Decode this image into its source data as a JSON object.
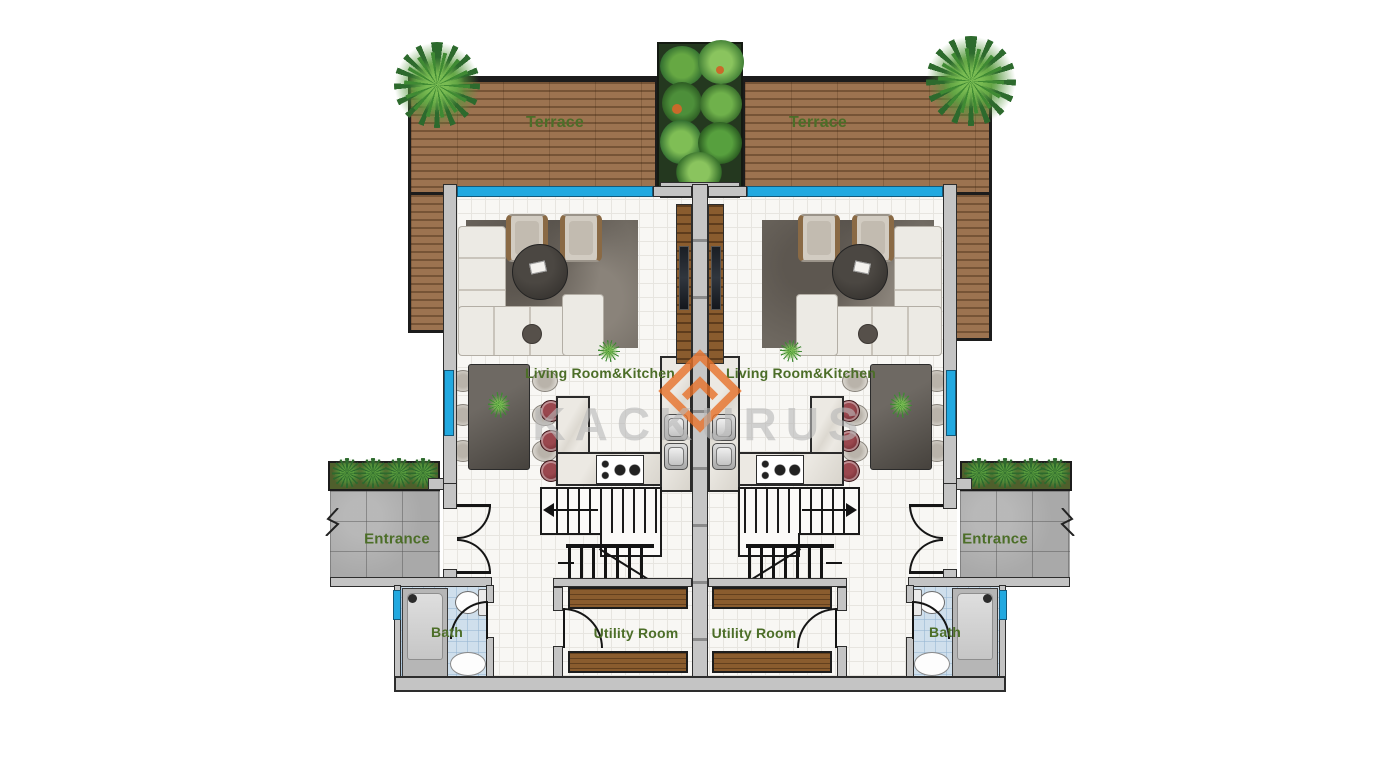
{
  "document": {
    "kind": "Architectural floor plan, twin / duplex villa, mirrored units",
    "units": 2
  },
  "watermark": {
    "brand": "KACKURUS",
    "logo": "kackurus-diamond-chevron-logo",
    "logo_color": "#e8722a",
    "text_color": "#bdbdbd"
  },
  "labels": {
    "terrace": "Terrace",
    "living_kitchen": "Living Room&Kitchen",
    "entrance": "Entrance",
    "bath": "Bath",
    "utility": "Utility Room"
  },
  "colors": {
    "label_green": "#4c6e28",
    "terrace_wood": "#9c7350",
    "window_blue": "#22a9e0",
    "wall_gray": "#c4c4c4",
    "bath_tile_blue": "#cfdfec",
    "bar_stool_maroon": "#7a2e35",
    "plant_green": "#3e7d32",
    "floor_tile": "#f8f7f4"
  }
}
